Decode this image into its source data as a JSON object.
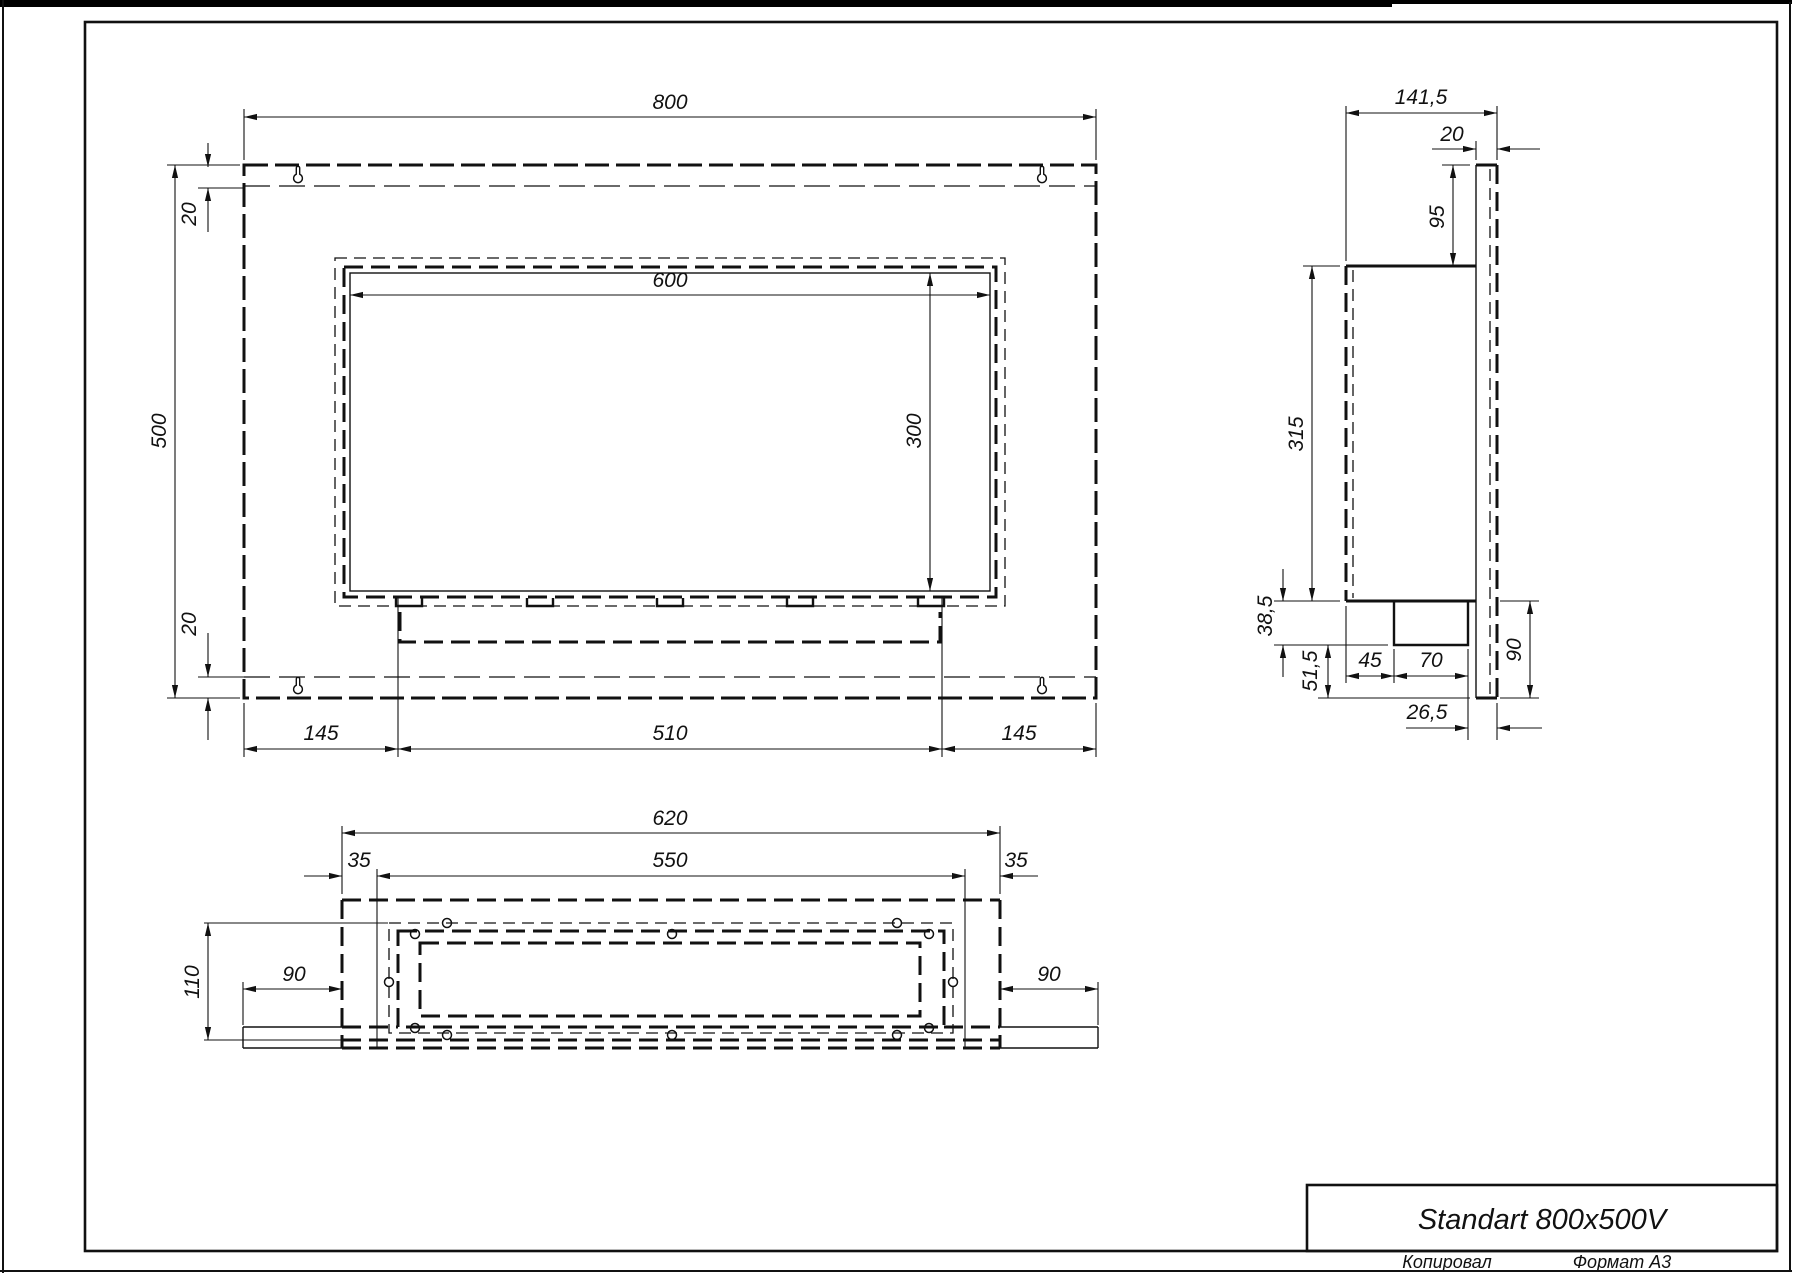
{
  "title_block": {
    "title": "Standart 800x500V",
    "footer_left": "Копировал",
    "footer_right": "Формат А3"
  },
  "views": {
    "front": {
      "overall_width": "800",
      "overall_height": "500",
      "top_strip": "20",
      "bottom_strip": "20",
      "opening_width": "600",
      "opening_height": "300",
      "tray_left_margin": "145",
      "tray_width": "510",
      "tray_right_margin": "145"
    },
    "side": {
      "overall_depth": "141,5",
      "panel_thickness": "20",
      "top_to_body": "95",
      "body_height": "315",
      "tray_drop": "38,5",
      "tray_to_bottom": "51,5",
      "tray_front_offset": "45",
      "tray_depth": "70",
      "tray_back_gap": "26,5",
      "below_body_height": "90"
    },
    "bottom": {
      "body_width": "620",
      "mount_width": "550",
      "mount_left_inset": "35",
      "mount_right_inset": "35",
      "body_depth": "110",
      "left_wing": "90",
      "right_wing": "90"
    }
  }
}
